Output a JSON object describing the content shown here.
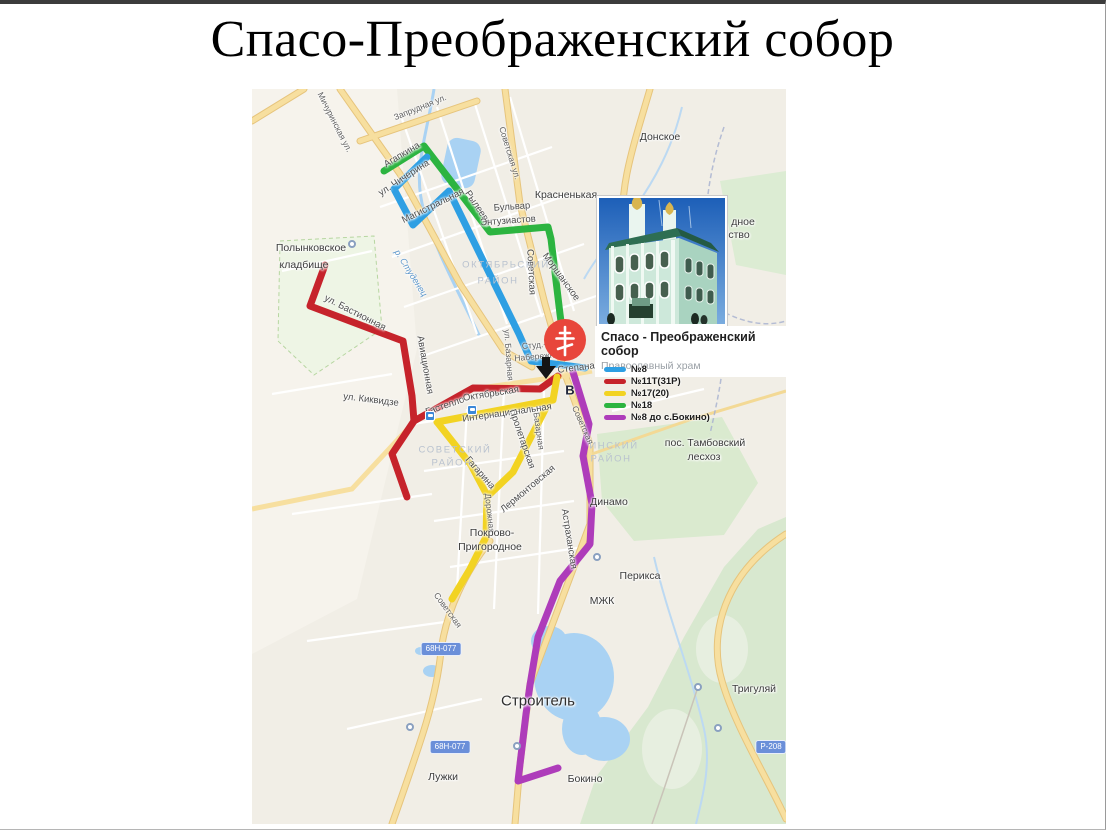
{
  "title": "Спасо-Преображенский собор",
  "card": {
    "title": "Спасо - Преображенский собор",
    "subtitle": "Православный храм"
  },
  "marker_letter": "В",
  "colors": {
    "route_blue": "#2e9fe3",
    "route_red": "#c6232b",
    "route_yellow": "#f2d322",
    "route_green": "#2cb440",
    "route_purple": "#ae3cba",
    "marker_red": "#e8463b",
    "road_badge_blue": "#6b8fd9"
  },
  "legend": [
    {
      "label": "№8",
      "color": "#2e9fe3"
    },
    {
      "label": "№11Т(31Р)",
      "color": "#c6232b"
    },
    {
      "label": "№17(20)",
      "color": "#f2d322"
    },
    {
      "label": "№18",
      "color": "#2cb440"
    },
    {
      "label": "№8 до с.Бокино)",
      "color": "#ae3cba"
    }
  ],
  "routes": [
    {
      "name": "route-18-green",
      "color": "#2cb440",
      "width": 7,
      "points": [
        [
          132,
          82
        ],
        [
          172,
          57
        ],
        [
          238,
          143
        ],
        [
          296,
          138
        ],
        [
          299,
          150
        ],
        [
          308,
          225
        ],
        [
          313,
          262
        ]
      ]
    },
    {
      "name": "route-8-blue",
      "color": "#2e9fe3",
      "width": 7,
      "points": [
        [
          175,
          68
        ],
        [
          142,
          100
        ],
        [
          161,
          136
        ],
        [
          197,
          102
        ],
        [
          267,
          245
        ],
        [
          279,
          272
        ],
        [
          333,
          279
        ]
      ]
    },
    {
      "name": "route-11t-red-main",
      "color": "#c6232b",
      "width": 7,
      "points": [
        [
          73,
          176
        ],
        [
          58,
          217
        ],
        [
          151,
          252
        ],
        [
          160,
          307
        ],
        [
          162,
          332
        ],
        [
          221,
          299
        ],
        [
          288,
          300
        ],
        [
          306,
          287
        ]
      ]
    },
    {
      "name": "route-11t-red-branch",
      "color": "#c6232b",
      "width": 7,
      "points": [
        [
          162,
          332
        ],
        [
          140,
          365
        ],
        [
          155,
          408
        ]
      ]
    },
    {
      "name": "route-17-yellow-main",
      "color": "#f2d322",
      "width": 7,
      "points": [
        [
          185,
          333
        ],
        [
          301,
          311
        ],
        [
          305,
          288
        ]
      ]
    },
    {
      "name": "route-17-yellow-proletarskaya",
      "color": "#f2d322",
      "width": 7,
      "points": [
        [
          296,
          315
        ],
        [
          261,
          383
        ],
        [
          237,
          406
        ]
      ]
    },
    {
      "name": "route-17-yellow-gagarina",
      "color": "#f2d322",
      "width": 7,
      "points": [
        [
          185,
          333
        ],
        [
          219,
          376
        ],
        [
          235,
          406
        ],
        [
          234,
          448
        ],
        [
          218,
          480
        ],
        [
          200,
          510
        ]
      ]
    },
    {
      "name": "route-8-bokino-purple",
      "color": "#ae3cba",
      "width": 7,
      "points": [
        [
          321,
          283
        ],
        [
          337,
          335
        ],
        [
          331,
          367
        ],
        [
          340,
          415
        ],
        [
          338,
          455
        ],
        [
          308,
          492
        ],
        [
          286,
          548
        ],
        [
          278,
          596
        ],
        [
          274,
          625
        ],
        [
          266,
          692
        ],
        [
          306,
          679
        ]
      ]
    }
  ],
  "labels": [
    {
      "text": "Мичуринская ул.",
      "x": 83,
      "y": 33,
      "rot": 63,
      "cls": "street"
    },
    {
      "text": "Запрудная ул.",
      "x": 168,
      "y": 18,
      "rot": -22,
      "cls": "street"
    },
    {
      "text": "Агапкина",
      "x": 150,
      "y": 66,
      "rot": -31,
      "cls": "street-lg"
    },
    {
      "text": "ул. Чичерина",
      "x": 152,
      "y": 89,
      "rot": -33,
      "cls": "street-lg"
    },
    {
      "text": "Магистральная",
      "x": 181,
      "y": 117,
      "rot": -26,
      "cls": "street-lg"
    },
    {
      "text": "Рылеева",
      "x": 226,
      "y": 119,
      "rot": 56,
      "cls": "street-lg"
    },
    {
      "text": "Советская ул.",
      "x": 258,
      "y": 64,
      "rot": 73,
      "cls": "street"
    },
    {
      "text": "Бульвар",
      "x": 260,
      "y": 118,
      "rot": -4,
      "cls": "street-lg"
    },
    {
      "text": "Энтузиастов",
      "x": 256,
      "y": 132,
      "rot": -4,
      "cls": "street-lg"
    },
    {
      "text": "Советская",
      "x": 279,
      "y": 183,
      "rot": 87,
      "cls": "street-lg"
    },
    {
      "text": "Моршанское",
      "x": 309,
      "y": 188,
      "rot": 54,
      "cls": "street-lg"
    },
    {
      "text": "ул. Бастионная",
      "x": 103,
      "y": 224,
      "rot": 27,
      "cls": "street-lg"
    },
    {
      "text": "Авиационная",
      "x": 173,
      "y": 276,
      "rot": 80,
      "cls": "street-lg"
    },
    {
      "text": "ул. Киквидзе",
      "x": 119,
      "y": 311,
      "rot": 7,
      "cls": "street-lg"
    },
    {
      "text": "Гастелло",
      "x": 193,
      "y": 317,
      "rot": -19,
      "cls": "street-lg"
    },
    {
      "text": "Октябрьская",
      "x": 239,
      "y": 305,
      "rot": -9,
      "cls": "street-lg"
    },
    {
      "text": "ул. Базарная",
      "x": 257,
      "y": 266,
      "rot": 86,
      "cls": "street"
    },
    {
      "text": "Студ.-",
      "x": 282,
      "y": 256,
      "rot": -5,
      "cls": "street"
    },
    {
      "text": "Набережная",
      "x": 287,
      "y": 267,
      "rot": -5,
      "cls": "street"
    },
    {
      "text": "Степана Разина",
      "x": 341,
      "y": 277,
      "rot": -7,
      "cls": "street-lg"
    },
    {
      "text": "Интернациональная",
      "x": 255,
      "y": 324,
      "rot": -8,
      "cls": "street-lg"
    },
    {
      "text": "Пролетарская",
      "x": 270,
      "y": 350,
      "rot": 71,
      "cls": "street-lg"
    },
    {
      "text": "Базарная",
      "x": 287,
      "y": 342,
      "rot": 82,
      "cls": "street"
    },
    {
      "text": "Гагарина",
      "x": 228,
      "y": 384,
      "rot": 49,
      "cls": "street-lg"
    },
    {
      "text": "Лермонтовская",
      "x": 276,
      "y": 400,
      "rot": -40,
      "cls": "street-lg"
    },
    {
      "text": "Дорожная",
      "x": 238,
      "y": 424,
      "rot": 84,
      "cls": "street"
    },
    {
      "text": "Советская",
      "x": 331,
      "y": 336,
      "rot": 66,
      "cls": "street"
    },
    {
      "text": "Астраханская",
      "x": 317,
      "y": 450,
      "rot": 81,
      "cls": "street-lg"
    },
    {
      "text": "Советская",
      "x": 196,
      "y": 521,
      "rot": 54,
      "cls": "street"
    },
    {
      "text": "р. Студенец",
      "x": 159,
      "y": 184,
      "rot": 58,
      "cls": "water"
    },
    {
      "text": "Красненькая",
      "x": 314,
      "y": 106,
      "rot": 0,
      "cls": "place"
    },
    {
      "text": "Донское",
      "x": 408,
      "y": 48,
      "rot": 0,
      "cls": "place"
    },
    {
      "text": "Полынковское",
      "x": 59,
      "y": 159,
      "rot": 0,
      "cls": "place"
    },
    {
      "text": "кладбище",
      "x": 52,
      "y": 176,
      "rot": 0,
      "cls": "place"
    },
    {
      "text": "пос. Тамбовский",
      "x": 453,
      "y": 354,
      "rot": 0,
      "cls": "place"
    },
    {
      "text": "лесхоз",
      "x": 452,
      "y": 368,
      "rot": 0,
      "cls": "place"
    },
    {
      "text": "Динамо",
      "x": 357,
      "y": 413,
      "rot": 0,
      "cls": "place"
    },
    {
      "text": "Перикса",
      "x": 388,
      "y": 487,
      "rot": 0,
      "cls": "place"
    },
    {
      "text": "МЖК",
      "x": 350,
      "y": 512,
      "rot": 0,
      "cls": "place"
    },
    {
      "text": "Покрово-",
      "x": 240,
      "y": 444,
      "rot": 0,
      "cls": "place"
    },
    {
      "text": "Пригородное",
      "x": 238,
      "y": 458,
      "rot": 0,
      "cls": "place"
    },
    {
      "text": "Лужки",
      "x": 191,
      "y": 688,
      "rot": 0,
      "cls": "place"
    },
    {
      "text": "Бокино",
      "x": 333,
      "y": 690,
      "rot": 0,
      "cls": "place"
    },
    {
      "text": "Тригуляй",
      "x": 502,
      "y": 600,
      "rot": 0,
      "cls": "place"
    },
    {
      "text": "дное",
      "x": 491,
      "y": 133,
      "rot": 0,
      "cls": "place"
    },
    {
      "text": "ство",
      "x": 487,
      "y": 146,
      "rot": 0,
      "cls": "place"
    },
    {
      "text": "Строитель",
      "x": 286,
      "y": 612,
      "rot": 0,
      "cls": "town"
    },
    {
      "text": "ОКТЯБРЬСКИЙ",
      "x": 254,
      "y": 176,
      "rot": 0,
      "cls": "district"
    },
    {
      "text": "РАЙОН",
      "x": 246,
      "y": 192,
      "rot": 0,
      "cls": "district"
    },
    {
      "text": "СОВЕТСКИЙ",
      "x": 203,
      "y": 361,
      "rot": 0,
      "cls": "district"
    },
    {
      "text": "РАЙОН",
      "x": 200,
      "y": 374,
      "rot": 0,
      "cls": "district"
    },
    {
      "text": "ИНСКИЙ",
      "x": 362,
      "y": 357,
      "rot": 0,
      "cls": "district"
    },
    {
      "text": "РАЙОН",
      "x": 359,
      "y": 370,
      "rot": 0,
      "cls": "district"
    }
  ],
  "badges": [
    {
      "text": "68Н-077",
      "x": 189,
      "y": 560
    },
    {
      "text": "68Н-077",
      "x": 198,
      "y": 658
    },
    {
      "text": "Р-208",
      "x": 519,
      "y": 658
    }
  ],
  "stops": [
    {
      "x": 178,
      "y": 327
    },
    {
      "x": 220,
      "y": 321
    }
  ],
  "circles": [
    {
      "x": 100,
      "y": 155
    },
    {
      "x": 345,
      "y": 468
    },
    {
      "x": 265,
      "y": 657
    },
    {
      "x": 158,
      "y": 638
    },
    {
      "x": 446,
      "y": 598
    },
    {
      "x": 466,
      "y": 639
    }
  ]
}
